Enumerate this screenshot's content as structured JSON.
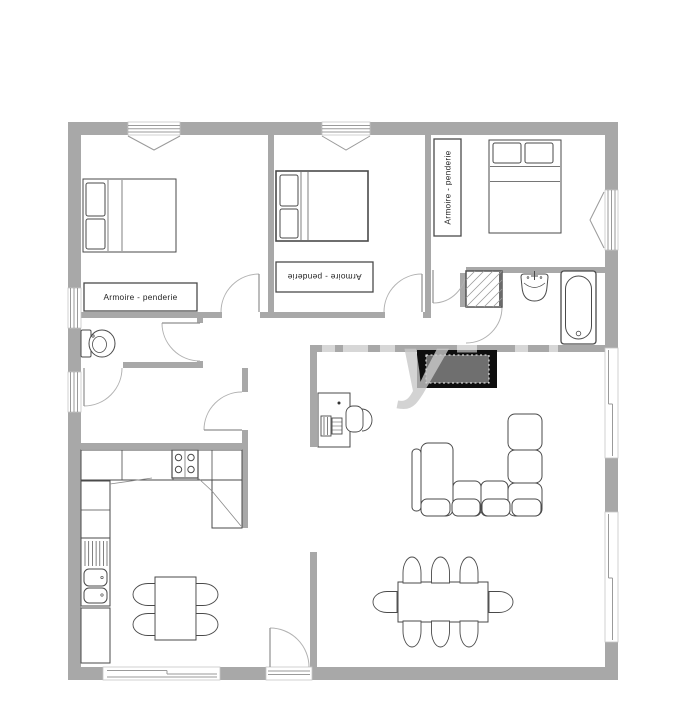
{
  "labels": {
    "wardrobe_bedroom_left": "Armoire - penderie",
    "wardrobe_bedroom_middle": "Armoire - penderie",
    "wardrobe_bedroom_right": "Armoire - penderie"
  },
  "watermark": {
    "text": "y"
  },
  "colors": {
    "wall": "#a8a8a8",
    "window_line": "#9a9a9a",
    "window_frame": "#c6c6c6",
    "door_arc": "#b2b2b2",
    "door_leaf": "#8f8f8f",
    "furniture_outline": "#4a4a4a",
    "label_text": "#1f1f1f",
    "tv_frame": "#0e0e0e",
    "tv_screen": "#6f6f6f",
    "watermark": "#c9c9c9",
    "background": "#ffffff"
  }
}
